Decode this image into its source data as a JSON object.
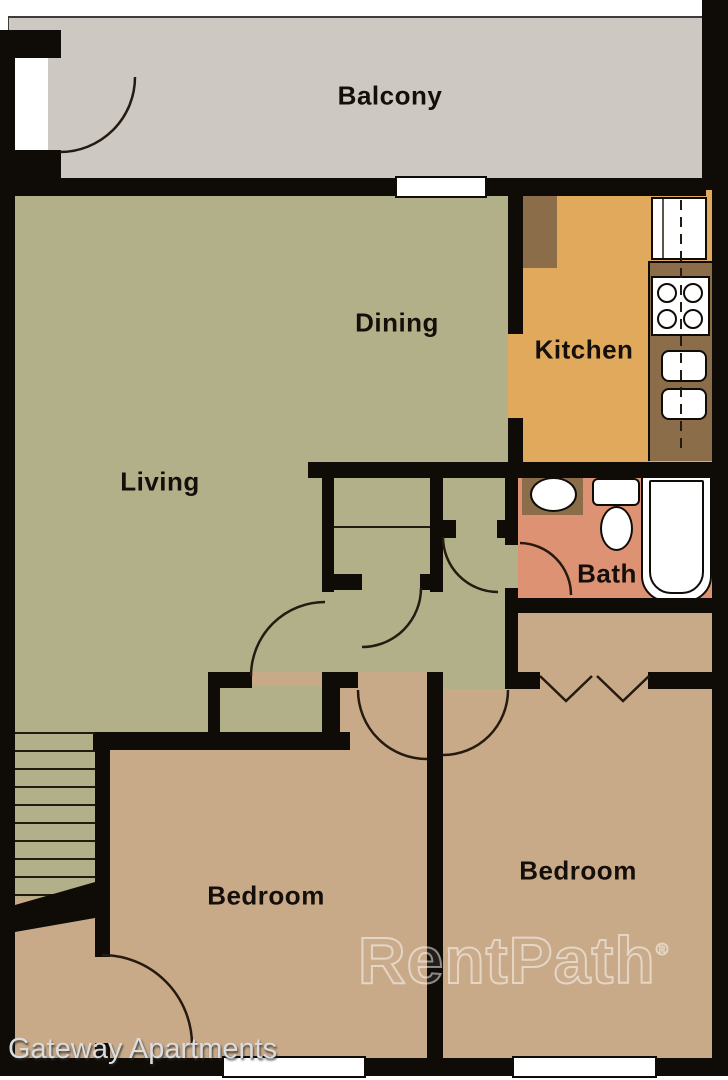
{
  "labels": {
    "balcony": "Balcony",
    "dining": "Dining",
    "kitchen": "Kitchen",
    "living": "Living",
    "bath": "Bath",
    "bedroom_left": "Bedroom",
    "bedroom_right": "Bedroom"
  },
  "caption": "Gateway Apartments",
  "watermark": {
    "text": "RentPath",
    "registered": "®"
  },
  "colors": {
    "wall": "#0f0c08",
    "balcony": "#cdc8c2",
    "green": "#b2b089",
    "kitchen": "#e1a95c",
    "brown": "#8b6d4a",
    "bath": "#de9274",
    "tan": "#c9aa88",
    "line": "#241a10",
    "window": "#ffffff",
    "label": "#140f0a",
    "caption": "#dcdcdc"
  }
}
